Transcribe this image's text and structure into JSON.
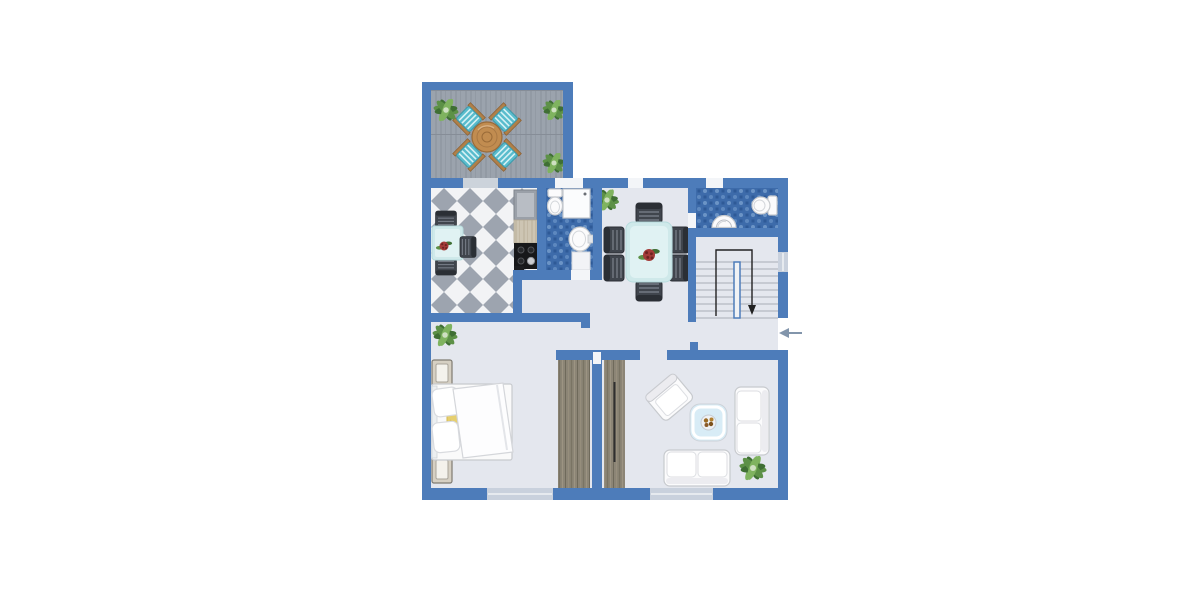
{
  "meta": {
    "kind": "apartment-floor-plan",
    "canvas": {
      "width": 1200,
      "height": 600
    }
  },
  "palette": {
    "wall": "#4d7cba",
    "floor": "#e4e7ee",
    "deck_base": "#9ba3ad",
    "deck_line": "#8a919c",
    "deck_seam": "#868d97",
    "checker_light": "#f2f3f5",
    "checker_dark": "#9da4af",
    "tile_base": "#3d6baa",
    "tile_light": "#6b94c6",
    "tile_mid": "#5d88bf",
    "tile_dark": "#2e5a97",
    "window_gap": "#c9d1dd",
    "door_gap": "#ccd3db",
    "open_gap": "#f3f5f8",
    "white_furniture": "#fbfbfc",
    "furn_stroke": "#c7cace",
    "chair_dark": "#40454d",
    "chair_stripe": "#737983",
    "chair_edge": "#2b2f35",
    "table_teal": "#cfe9ea",
    "table_teal_light": "#e0f2f3",
    "coffee_table": "#d8ecf6",
    "wood_table": "#c18c50",
    "wood_table_line": "#9a6b38",
    "chair_teal": "#59bccd",
    "chair_teal_stripe": "#d6f1f4",
    "wood_frame": "#b08049",
    "wardrobe_base": "#8c8576",
    "wardrobe_line_dark": "#7a7464",
    "wardrobe_line_light": "#9c9482",
    "counter_base": "#cdc5b3",
    "counter_line": "#b9af9a",
    "appliance": "#9aa0a8",
    "stove": "#17181a",
    "bed_yellow": "#e6cf6f",
    "plant_dark": "#3f6f34",
    "plant_mid": "#5d9147",
    "plant_light": "#7fb35f",
    "arrow_entry": "#8295ab",
    "stair_line": "#a8adb7",
    "path_dark": "#222222",
    "flower_red": "#a33b38",
    "fruit_brown": "#9a6a23"
  },
  "symbols": {
    "entry_arrow": "left-arrow",
    "stairs_arrow": "down-arrow"
  },
  "rooms": [
    {
      "id": "terrace",
      "furniture": [
        "round-table",
        "chair",
        "chair",
        "chair",
        "chair",
        "plant",
        "plant",
        "plant"
      ]
    },
    {
      "id": "kitchen",
      "furniture": [
        "refrigerator",
        "counter",
        "stove",
        "table",
        "chair",
        "chair",
        "chair",
        "flower"
      ]
    },
    {
      "id": "bathroom",
      "furniture": [
        "toilet",
        "shower",
        "sink",
        "bath-mat"
      ]
    },
    {
      "id": "dining-room",
      "furniture": [
        "dining-table",
        "chair",
        "chair",
        "chair",
        "chair",
        "chair",
        "chair",
        "centerpiece",
        "plant"
      ]
    },
    {
      "id": "wc",
      "furniture": [
        "toilet",
        "sink"
      ]
    },
    {
      "id": "staircase",
      "furniture": [
        "stairs",
        "direction-arrow"
      ]
    },
    {
      "id": "hallway",
      "furniture": [
        "plant"
      ]
    },
    {
      "id": "bedroom",
      "furniture": [
        "double-bed",
        "nightstand",
        "nightstand",
        "wardrobe"
      ]
    },
    {
      "id": "living-room",
      "furniture": [
        "wardrobe",
        "armchair",
        "coffee-table",
        "fruit-bowl",
        "sofa",
        "sofa",
        "plant"
      ]
    }
  ]
}
